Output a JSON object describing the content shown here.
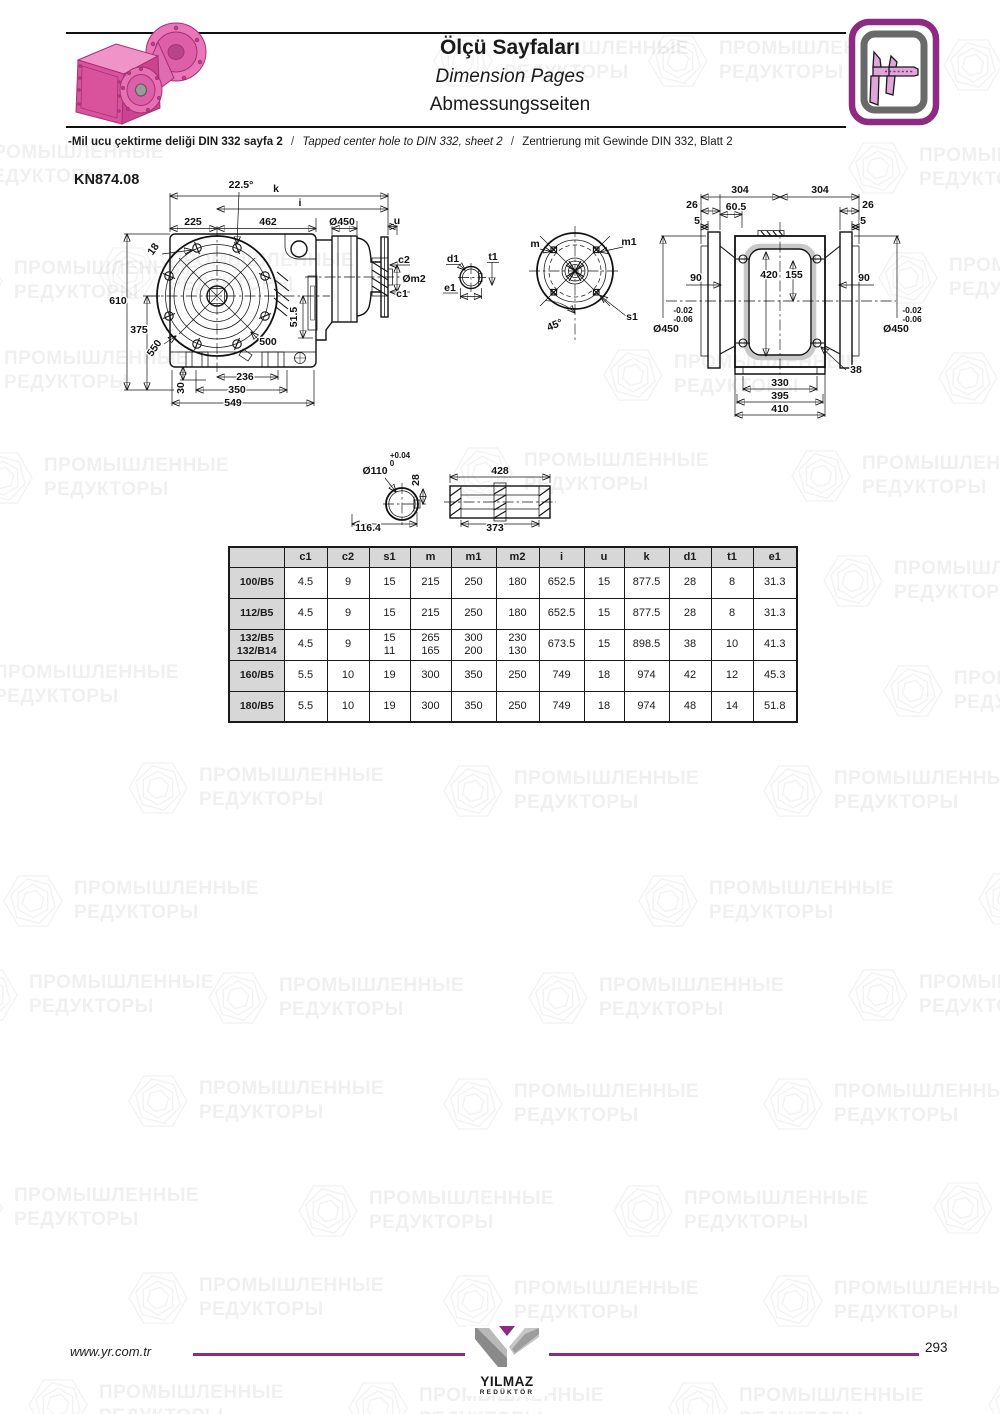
{
  "header": {
    "title_tr": "Ölçü Sayfaları",
    "title_en": "Dimension Pages",
    "title_de": "Abmessungsseiten",
    "note_tr": "-Mil ucu çektirme deliği DIN 332 sayfa 2",
    "note_en": "Tapped center hole to DIN 332, sheet 2",
    "note_de": "Zentrierung mit Gewinde DIN 332, Blatt 2",
    "note_sep": "/",
    "icon": "caliper"
  },
  "model": "KN874.08",
  "watermark": {
    "line1": "ПРОМЫШЛЕННЫЕ",
    "line2": "РЕДУКТОРЫ"
  },
  "drawings": {
    "front_view": {
      "labels": [
        {
          "t": "22.5°",
          "x": 241,
          "y": 188
        },
        {
          "t": "k",
          "x": 276,
          "y": 192
        },
        {
          "t": "i",
          "x": 300,
          "y": 206
        },
        {
          "t": "225",
          "x": 193,
          "y": 225
        },
        {
          "t": "462",
          "x": 268,
          "y": 225
        },
        {
          "t": "Ø450",
          "x": 342,
          "y": 225
        },
        {
          "t": "u",
          "x": 397,
          "y": 224
        },
        {
          "t": "18",
          "x": 156,
          "y": 251,
          "r": -55
        },
        {
          "t": "610",
          "x": 118,
          "y": 304
        },
        {
          "t": "375",
          "x": 139,
          "y": 333
        },
        {
          "t": "550",
          "x": 157,
          "y": 350,
          "r": -55
        },
        {
          "t": "500",
          "x": 268,
          "y": 345
        },
        {
          "t": "51.5",
          "x": 297,
          "y": 317,
          "r": -90
        },
        {
          "t": "30",
          "x": 184,
          "y": 388,
          "r": -90
        },
        {
          "t": "236",
          "x": 245,
          "y": 380
        },
        {
          "t": "350",
          "x": 237,
          "y": 393
        },
        {
          "t": "549",
          "x": 233,
          "y": 406
        },
        {
          "t": "c2",
          "x": 404,
          "y": 263
        },
        {
          "t": "Øm2",
          "x": 414,
          "y": 282
        },
        {
          "t": "c1",
          "x": 402,
          "y": 297
        }
      ]
    },
    "shaft_detail": {
      "labels": [
        {
          "t": "d1",
          "x": 453,
          "y": 262
        },
        {
          "t": "t1",
          "x": 493,
          "y": 260
        },
        {
          "t": "e1",
          "x": 450,
          "y": 291
        }
      ]
    },
    "flange_view": {
      "labels": [
        {
          "t": "m",
          "x": 535,
          "y": 247
        },
        {
          "t": "m1",
          "x": 629,
          "y": 245
        },
        {
          "t": "s1",
          "x": 632,
          "y": 320
        },
        {
          "t": "45°",
          "x": 556,
          "y": 328,
          "r": -22
        }
      ]
    },
    "side_view": {
      "labels": [
        {
          "t": "304",
          "x": 740,
          "y": 193
        },
        {
          "t": "304",
          "x": 820,
          "y": 193
        },
        {
          "t": "26",
          "x": 692,
          "y": 208
        },
        {
          "t": "26",
          "x": 868,
          "y": 208
        },
        {
          "t": "60.5",
          "x": 736,
          "y": 210
        },
        {
          "t": "5",
          "x": 697,
          "y": 224
        },
        {
          "t": "5",
          "x": 863,
          "y": 224
        },
        {
          "t": "90",
          "x": 696,
          "y": 281
        },
        {
          "t": "90",
          "x": 864,
          "y": 281
        },
        {
          "t": "420",
          "x": 769,
          "y": 278
        },
        {
          "t": "155",
          "x": 794,
          "y": 278
        },
        {
          "t": "-0.02",
          "x": 683,
          "y": 313,
          "fs": 8.5
        },
        {
          "t": "-0.06",
          "x": 683,
          "y": 322,
          "fs": 8.5
        },
        {
          "t": "Ø450",
          "x": 666,
          "y": 332
        },
        {
          "t": "-0.02",
          "x": 912,
          "y": 313,
          "fs": 8.5
        },
        {
          "t": "-0.06",
          "x": 912,
          "y": 322,
          "fs": 8.5
        },
        {
          "t": "Ø450",
          "x": 896,
          "y": 332
        },
        {
          "t": "38",
          "x": 856,
          "y": 373
        },
        {
          "t": "330",
          "x": 780,
          "y": 386
        },
        {
          "t": "395",
          "x": 780,
          "y": 399
        },
        {
          "t": "410",
          "x": 780,
          "y": 412
        }
      ]
    },
    "shaft_section": {
      "labels": [
        {
          "t": "+0.04",
          "x": 400,
          "y": 458,
          "fs": 8
        },
        {
          "t": "0",
          "x": 392,
          "y": 466,
          "fs": 8
        },
        {
          "t": "Ø110",
          "x": 375,
          "y": 474
        },
        {
          "t": "28",
          "x": 419,
          "y": 480,
          "r": -90
        },
        {
          "t": "116.4",
          "x": 368,
          "y": 531
        },
        {
          "t": "428",
          "x": 500,
          "y": 474
        },
        {
          "t": "373",
          "x": 495,
          "y": 531
        }
      ]
    }
  },
  "table": {
    "headers": [
      "",
      "c1",
      "c2",
      "s1",
      "m",
      "m1",
      "m2",
      "i",
      "u",
      "k",
      "d1",
      "t1",
      "e1"
    ],
    "rows": [
      {
        "label": "100/B5",
        "values": [
          "4.5",
          "9",
          "15",
          "215",
          "250",
          "180",
          "652.5",
          "15",
          "877.5",
          "28",
          "8",
          "31.3"
        ]
      },
      {
        "label": "112/B5",
        "values": [
          "4.5",
          "9",
          "15",
          "215",
          "250",
          "180",
          "652.5",
          "15",
          "877.5",
          "28",
          "8",
          "31.3"
        ]
      },
      {
        "label": "132/B5\n132/B14",
        "values": [
          "4.5",
          "9",
          "15\n11",
          "265\n165",
          "300\n200",
          "230\n130",
          "673.5",
          "15",
          "898.5",
          "38",
          "10",
          "41.3"
        ]
      },
      {
        "label": "160/B5",
        "values": [
          "5.5",
          "10",
          "19",
          "300",
          "350",
          "250",
          "749",
          "18",
          "974",
          "42",
          "12",
          "45.3"
        ]
      },
      {
        "label": "180/B5",
        "values": [
          "5.5",
          "10",
          "19",
          "300",
          "350",
          "250",
          "749",
          "18",
          "974",
          "48",
          "14",
          "51.8"
        ]
      }
    ]
  },
  "footer": {
    "website": "www.yr.com.tr",
    "page": "293",
    "logo_line1": "YILMAZ",
    "logo_line2": "REDÜKTÖR"
  },
  "colors": {
    "accent_purple": "#8e2a84",
    "gearbox_pink": "#d9529c",
    "table_header_bg": "#d7d7d7"
  }
}
